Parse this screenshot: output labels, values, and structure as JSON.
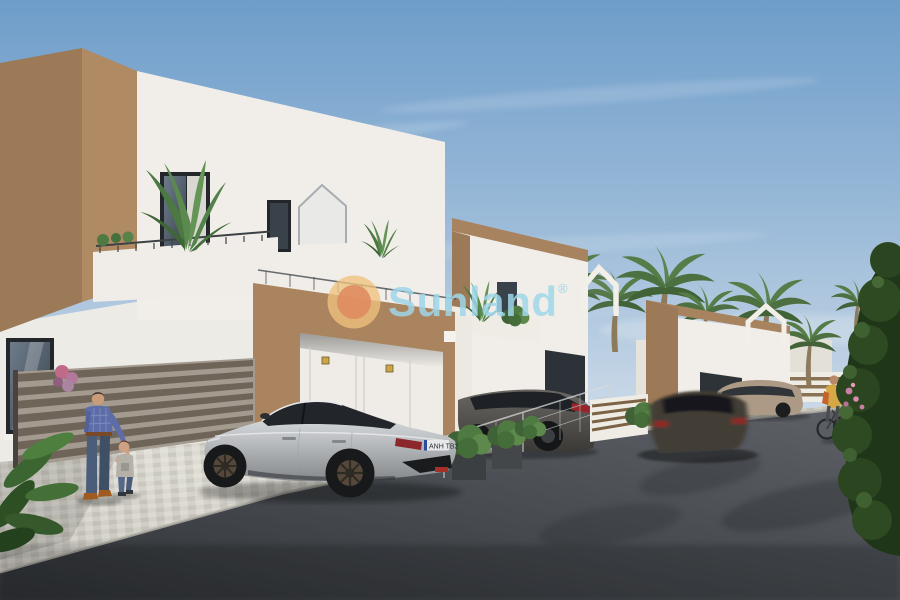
{
  "watermark": {
    "brand": "Sunland",
    "registered": "®",
    "text_color": "#9fd6e9",
    "sun_outer_color": "#eec27d",
    "sun_inner_color": "#df8a60"
  },
  "vehicles": {
    "audi": {
      "description": "silver sportback parked on paver driveway",
      "plate": "ANH TB2",
      "plate_band_color": "#2a4da0"
    },
    "grey_suv": {
      "description": "dark grey SUV parked behind mesh fence"
    },
    "moving_car": {
      "description": "dark car driving on street, motion blurred"
    },
    "beige_suv": {
      "description": "beige SUV parked along far kerb"
    }
  },
  "people": {
    "man": {
      "description": "man in blue plaid shirt and jeans holding toddler's hand"
    },
    "toddler": {
      "description": "toddler in grey t-shirt and jeans"
    },
    "cyclist": {
      "description": "cyclist in yellow-orange top riding on street"
    }
  },
  "scene": {
    "setting": "architectural render of modern two-storey villas with brown-and-white facades on a palm-lined street",
    "sky": "clear blue sky with thin wispy clouds",
    "vegetation": [
      "balcony banana plants",
      "palm trees",
      "dark green hedge with pink flowers",
      "foreground leaves"
    ],
    "ground": [
      "light paver driveway",
      "dark asphalt street"
    ]
  },
  "palette": {
    "sky_top": "#6e9dca",
    "sky_bottom": "#ccdae8",
    "facade_white": "#f1eee9",
    "facade_brown_front": "#b08a62",
    "facade_brown_side": "#9d7a57",
    "asphalt": "#44484d",
    "paver": "#d8d6cd",
    "hedge_green": "#203618",
    "palm_green": "#4d7040",
    "audi_silver": "#c4c7ca",
    "suv_grey": "#55534f",
    "suv_beige": "#ac9a86",
    "car_dark": "#423c35"
  }
}
